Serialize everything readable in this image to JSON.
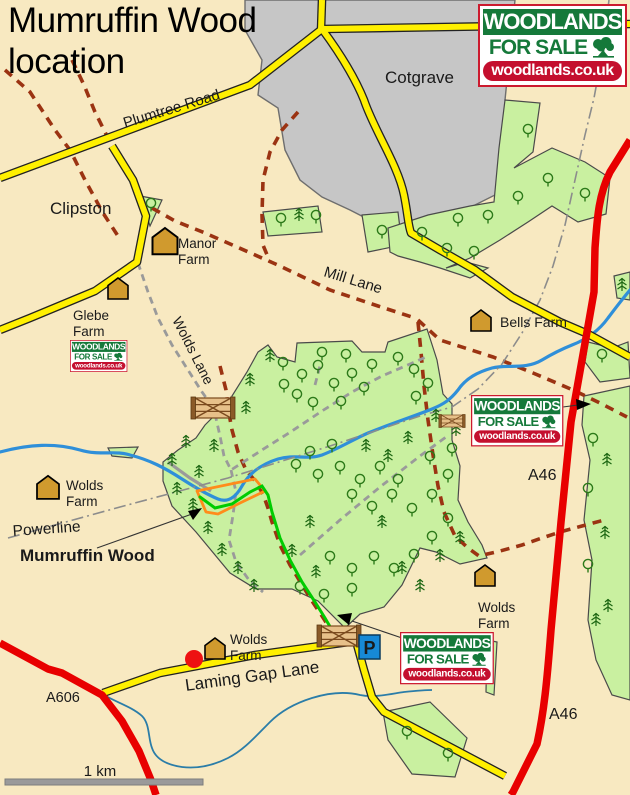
{
  "title": {
    "line1": "Mumruffin Wood",
    "line2": "location"
  },
  "logo": {
    "line1": "WOODLANDS",
    "line2": "FOR SALE",
    "line3": "woodlands.co.uk",
    "tree_icon": "oak-tree-icon"
  },
  "labels": {
    "plumtree_road": "Plumtree Road",
    "clipston": "Clipston",
    "cotgrave": "Cotgrave",
    "mill_lane": "Mill Lane",
    "wolds_lane": "Wolds Lane",
    "powerline": "Powerline",
    "mumruffin_wood": "Mumruffin Wood",
    "laming_gap_lane": "Laming Gap Lane",
    "a46_north": "A46",
    "a46_south": "A46",
    "a606": "A606",
    "scale": "1 km",
    "parking": "P"
  },
  "farms": {
    "manor": [
      "Manor",
      "Farm"
    ],
    "glebe": [
      "Glebe",
      "Farm"
    ],
    "bells": [
      "Bells Farm"
    ],
    "wolds_west": [
      "Wolds",
      "Farm"
    ],
    "wolds_east": [
      "Wolds",
      "Farm"
    ],
    "wolds_south": [
      "Wolds",
      "Farm"
    ]
  },
  "colors": {
    "background": "#F8E9C1",
    "woodland_fill": "#C9F0A0",
    "urban_fill": "#C6C6C6",
    "minor_road": "#FFF000",
    "a_road": "#E80000",
    "bridleway_dash": "#9B3312",
    "track_dash": "#9A9A9A",
    "stream": "#2F8FD9",
    "route_green": "#00CC00",
    "boundary_orange": "#FF8C1A",
    "farm_icon": "#D09A2E",
    "logo_green": "#15793A",
    "logo_red": "#C40F2E",
    "parking_blue": "#1789D6"
  },
  "trees": {
    "deciduous": [
      [
        283,
        366
      ],
      [
        302,
        378
      ],
      [
        318,
        369
      ],
      [
        334,
        387
      ],
      [
        352,
        377
      ],
      [
        364,
        391
      ],
      [
        297,
        398
      ],
      [
        313,
        406
      ],
      [
        341,
        405
      ],
      [
        284,
        388
      ],
      [
        322,
        356
      ],
      [
        346,
        358
      ],
      [
        372,
        368
      ],
      [
        398,
        361
      ],
      [
        414,
        373
      ],
      [
        428,
        387
      ],
      [
        416,
        400
      ],
      [
        296,
        468
      ],
      [
        318,
        478
      ],
      [
        340,
        470
      ],
      [
        360,
        483
      ],
      [
        380,
        470
      ],
      [
        398,
        483
      ],
      [
        310,
        455
      ],
      [
        332,
        448
      ],
      [
        352,
        498
      ],
      [
        372,
        510
      ],
      [
        392,
        498
      ],
      [
        412,
        512
      ],
      [
        432,
        498
      ],
      [
        448,
        478
      ],
      [
        430,
        460
      ],
      [
        452,
        452
      ],
      [
        330,
        560
      ],
      [
        352,
        572
      ],
      [
        374,
        560
      ],
      [
        394,
        572
      ],
      [
        414,
        558
      ],
      [
        432,
        540
      ],
      [
        448,
        522
      ],
      [
        300,
        590
      ],
      [
        324,
        598
      ],
      [
        352,
        592
      ],
      [
        151,
        207
      ],
      [
        281,
        222
      ],
      [
        316,
        219
      ],
      [
        382,
        234
      ],
      [
        528,
        133
      ],
      [
        548,
        182
      ],
      [
        518,
        200
      ],
      [
        585,
        197
      ],
      [
        458,
        222
      ],
      [
        488,
        219
      ],
      [
        422,
        236
      ],
      [
        447,
        252
      ],
      [
        474,
        255
      ],
      [
        593,
        442
      ],
      [
        588,
        492
      ],
      [
        588,
        568
      ],
      [
        602,
        358
      ],
      [
        407,
        735
      ],
      [
        448,
        757
      ]
    ],
    "conifer": [
      [
        270,
        358
      ],
      [
        250,
        382
      ],
      [
        246,
        410
      ],
      [
        172,
        462
      ],
      [
        186,
        444
      ],
      [
        199,
        474
      ],
      [
        177,
        491
      ],
      [
        193,
        507
      ],
      [
        208,
        530
      ],
      [
        222,
        552
      ],
      [
        238,
        570
      ],
      [
        254,
        588
      ],
      [
        214,
        448
      ],
      [
        310,
        524
      ],
      [
        292,
        553
      ],
      [
        316,
        574
      ],
      [
        382,
        524
      ],
      [
        402,
        570
      ],
      [
        420,
        588
      ],
      [
        440,
        558
      ],
      [
        460,
        540
      ],
      [
        366,
        448
      ],
      [
        388,
        458
      ],
      [
        408,
        440
      ],
      [
        436,
        418
      ],
      [
        456,
        432
      ],
      [
        299,
        217
      ],
      [
        607,
        462
      ],
      [
        605,
        535
      ],
      [
        608,
        608
      ],
      [
        622,
        287
      ],
      [
        596,
        622
      ]
    ]
  }
}
